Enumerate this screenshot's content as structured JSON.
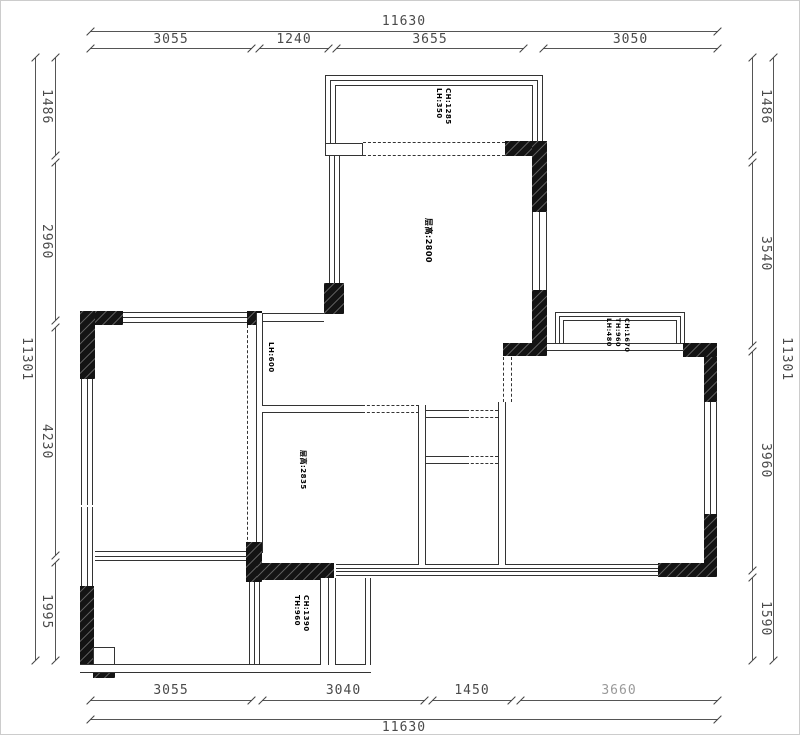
{
  "drawing": {
    "type": "residential floor plan",
    "units": "mm"
  },
  "dimensions": {
    "top": {
      "overall": "11630",
      "segments": [
        "3055",
        "1240",
        "3655",
        "3050"
      ]
    },
    "bottom": {
      "overall": "11630",
      "segments": [
        "3055",
        "3040",
        "1450",
        "3660"
      ]
    },
    "left": {
      "overall": "11301",
      "segments": [
        "1486",
        "2960",
        "4230",
        "1995"
      ]
    },
    "right": {
      "overall": "11301",
      "segments": [
        "1486",
        "3540",
        "3960",
        "1590"
      ]
    }
  },
  "labels": {
    "top_balcony": [
      "CH:1285",
      "LH:350"
    ],
    "living_room": [
      "层高:2800"
    ],
    "hall_opening": [
      "LH:600"
    ],
    "bay_window": [
      "CH:1670",
      "TH:960",
      "LH:480"
    ],
    "middle_room": [
      "层高:2835"
    ],
    "bottom_balcony": [
      "CH:1390",
      "TH:960"
    ]
  },
  "colors": {
    "wall": "#141414",
    "line": "#333333",
    "dim_text": "#4a4a4a",
    "faded_text": "#9a9a9a"
  }
}
